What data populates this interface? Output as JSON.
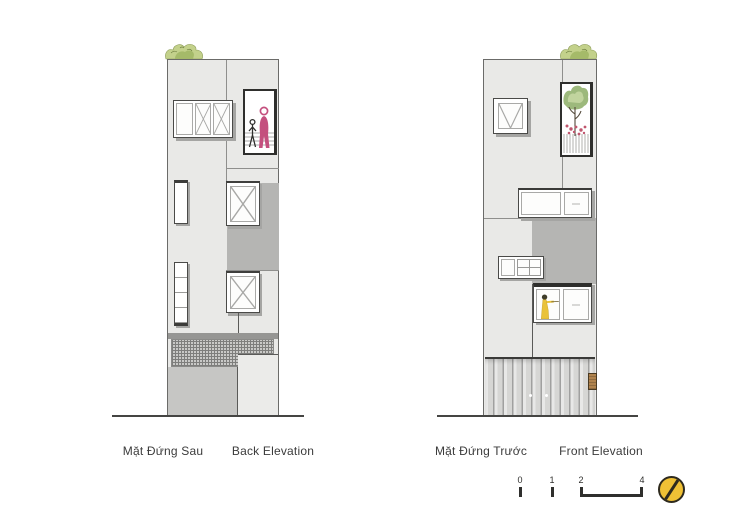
{
  "sheet": {
    "background": "#ffffff"
  },
  "elevations": {
    "back": {
      "label_vi": "Mặt Đứng Sau",
      "label_en": "Back Elevation"
    },
    "front": {
      "label_vi": "Mặt Đứng Trước",
      "label_en": "Front Elevation"
    }
  },
  "scale_bar": {
    "tick_0": "0",
    "tick_1": "1",
    "tick_2": "2",
    "tick_4": "4"
  },
  "icons": {
    "logo": "section-mark-circle-icon"
  },
  "colors": {
    "facade_light": "#e9e9e7",
    "facade_medium": "#c6c6c4",
    "facade_dark": "#b5b5b3",
    "band_dark": "#969694",
    "outline_dark": "#3a3a38",
    "joint_gray": "#8f8f8d",
    "figure_pink": "#c4507e",
    "figure_yellow": "#e9c23a",
    "plant_green": "#c3d18b",
    "plant_green_dark": "#9db97c",
    "flower_pink": "#c0566e",
    "logo_yellow": "#f0c135",
    "wood_tan": "#b0834e",
    "shadow_gray": "#a5a5a3"
  }
}
